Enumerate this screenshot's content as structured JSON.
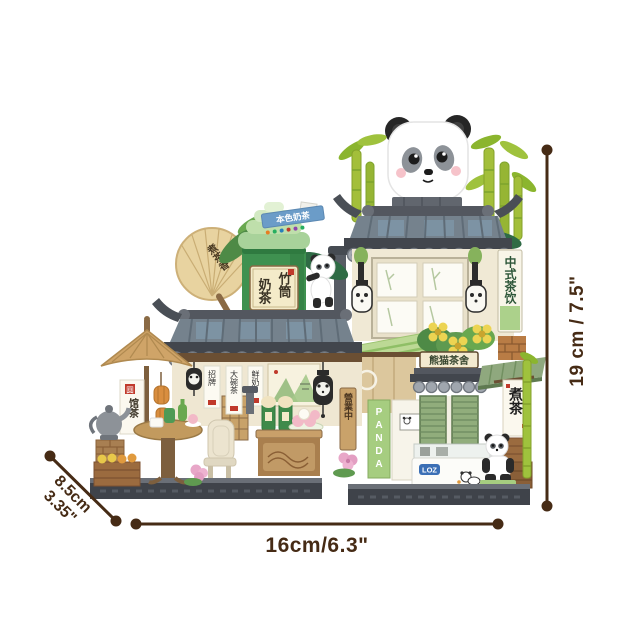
{
  "product": {
    "name": "Panda tea house mini building-block set",
    "brand": "LOZ"
  },
  "dimensions": {
    "height": "19 cm / 7.5\"",
    "width": "16cm/6.3\"",
    "depth_cm": "8.5cm",
    "depth_in": "3.35\""
  },
  "signs": {
    "roof_banner": "本色奶茶",
    "cup_label_right": "竹筒",
    "cup_label_left": "奶茶",
    "fan": "煮茶香",
    "stall_seal": "圆",
    "stall_banner": "馆茶",
    "hanging_banners": [
      "招牌",
      "大碗茶",
      "鲜奶"
    ],
    "open_sign": "營業中",
    "tower_side_sign": "中式茶饮",
    "awning_plaque": "熊猫茶舍",
    "door_strip": "PANDA",
    "boil_tea_banner": "煮茶",
    "freezer_logo": "LOZ"
  },
  "colors": {
    "annotation": "#462b15",
    "roof_tile": "#75828d",
    "bamboo_cup_green": "#3f9150",
    "awning_green": "#bcd995",
    "wall_cream": "#f0e9d5",
    "bamboo_yellow_green": "#a3bf3a"
  }
}
